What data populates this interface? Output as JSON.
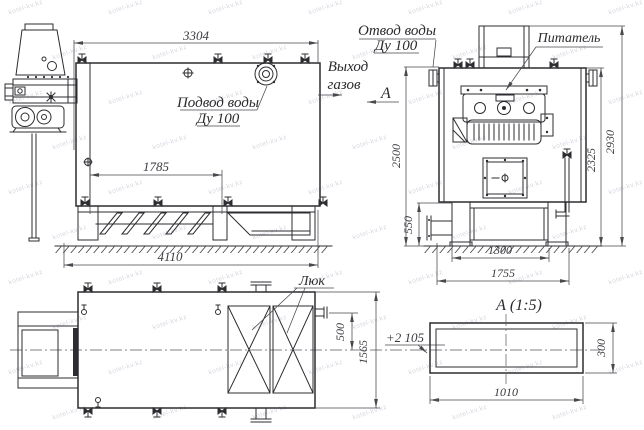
{
  "watermark": {
    "text": "kotel-kv.kz"
  },
  "views": {
    "side": {
      "labels": {
        "water_supply_1": "Подвод воды",
        "water_supply_2": "Ду 100"
      },
      "dims": {
        "top_width": "3304",
        "grate_span": "1785",
        "overall_length": "4110"
      }
    },
    "gas_outlet": {
      "line1": "Выход",
      "line2": "газов"
    },
    "section_arrow": {
      "letter": "А"
    },
    "end": {
      "labels": {
        "water_outlet_1": "Отвод воды",
        "water_outlet_2": "Ду 100",
        "feeder": "Питатель"
      },
      "dims": {
        "height_to_top": "2500",
        "base_height": "550",
        "base_span": "1300",
        "base_overall": "1755",
        "body_height": "2325",
        "overall_height": "2930"
      }
    },
    "plan": {
      "labels": {
        "hatch": "Люк",
        "elevation": "+2 105"
      },
      "dims": {
        "offset": "500",
        "width": "1565"
      }
    },
    "detail": {
      "title": "А (1:5)",
      "dims": {
        "width": "1010",
        "height": "300"
      }
    }
  },
  "colors": {
    "line": "#2d2d31",
    "dimension": "#48484d",
    "watermark": "#9aa2b5",
    "background": "#ffffff"
  }
}
